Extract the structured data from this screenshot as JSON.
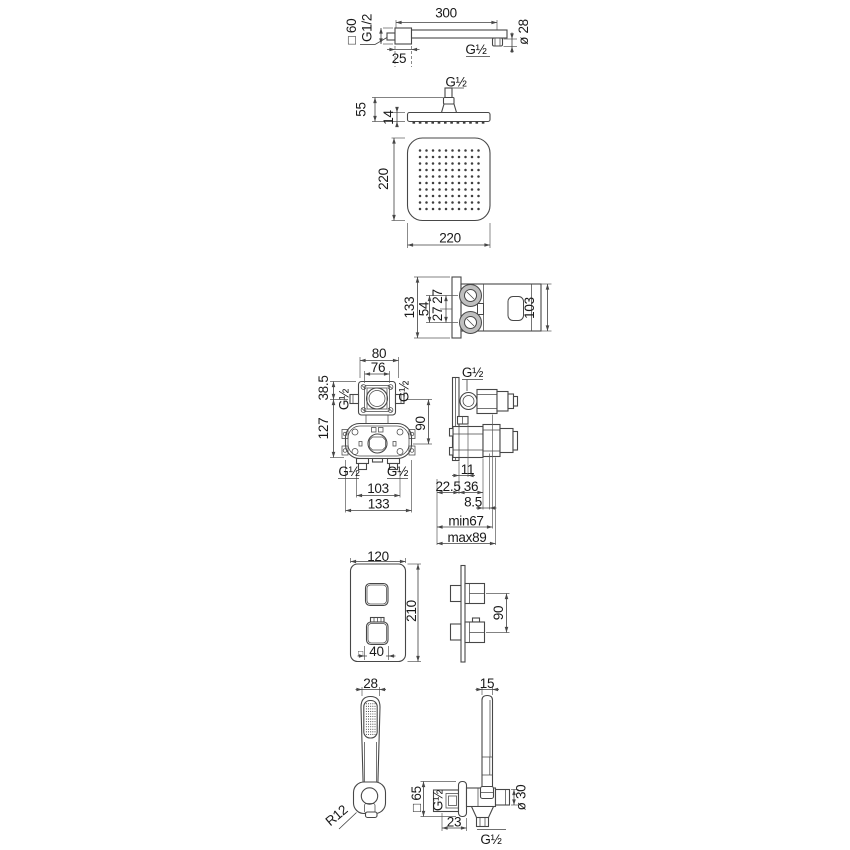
{
  "drawing": {
    "background": "#ffffff",
    "line_color": "#474747",
    "text_color": "#1a1a1a",
    "views": {
      "arm": {
        "length": "300",
        "flange_square": "□ 60",
        "wall_thread": "G1/2",
        "flange_depth": "25",
        "outlet_thread": "G½",
        "outlet_diameter": "ø 28"
      },
      "head_side": {
        "thread": "G½",
        "height": "55",
        "thickness": "14"
      },
      "head_front": {
        "width": "220",
        "height": "220",
        "nozzle_rows": 10,
        "nozzle_cols": 10
      },
      "mixer_side": {
        "height": "133",
        "port_spacing": "54",
        "port_offset_upper": "27",
        "port_offset_lower": "27",
        "body_height": "103"
      },
      "valve_front": {
        "box_width": "80",
        "box_inner_width": "76",
        "top_offset": "38.5",
        "left_thread": "G½",
        "right_thread": "G½",
        "height": "127",
        "port_drop": "90",
        "bottom_left_thread": "G½",
        "bottom_right_thread": "G½",
        "port_spacing": "103",
        "total_width": "133"
      },
      "valve_side": {
        "top_thread": "G½",
        "d1": "11",
        "d2": "22.5",
        "d3": "36",
        "d4": "8.5",
        "depth_min": "min67",
        "depth_max": "max89"
      },
      "plate_front": {
        "width": "120",
        "height": "210",
        "handle_square_symbol": "□",
        "handle_size": "40"
      },
      "plate_side": {
        "handle_spacing": "90"
      },
      "handshower_front": {
        "width": "28",
        "corner_radius": "R12",
        "nozzle_rows": 13,
        "nozzle_cols": 5
      },
      "handshower_side": {
        "width": "15",
        "flange_square": "□ 65",
        "flange_thread": "G½",
        "outlet_diameter": "ø 30",
        "depth": "23",
        "hose_thread": "G½"
      }
    }
  }
}
